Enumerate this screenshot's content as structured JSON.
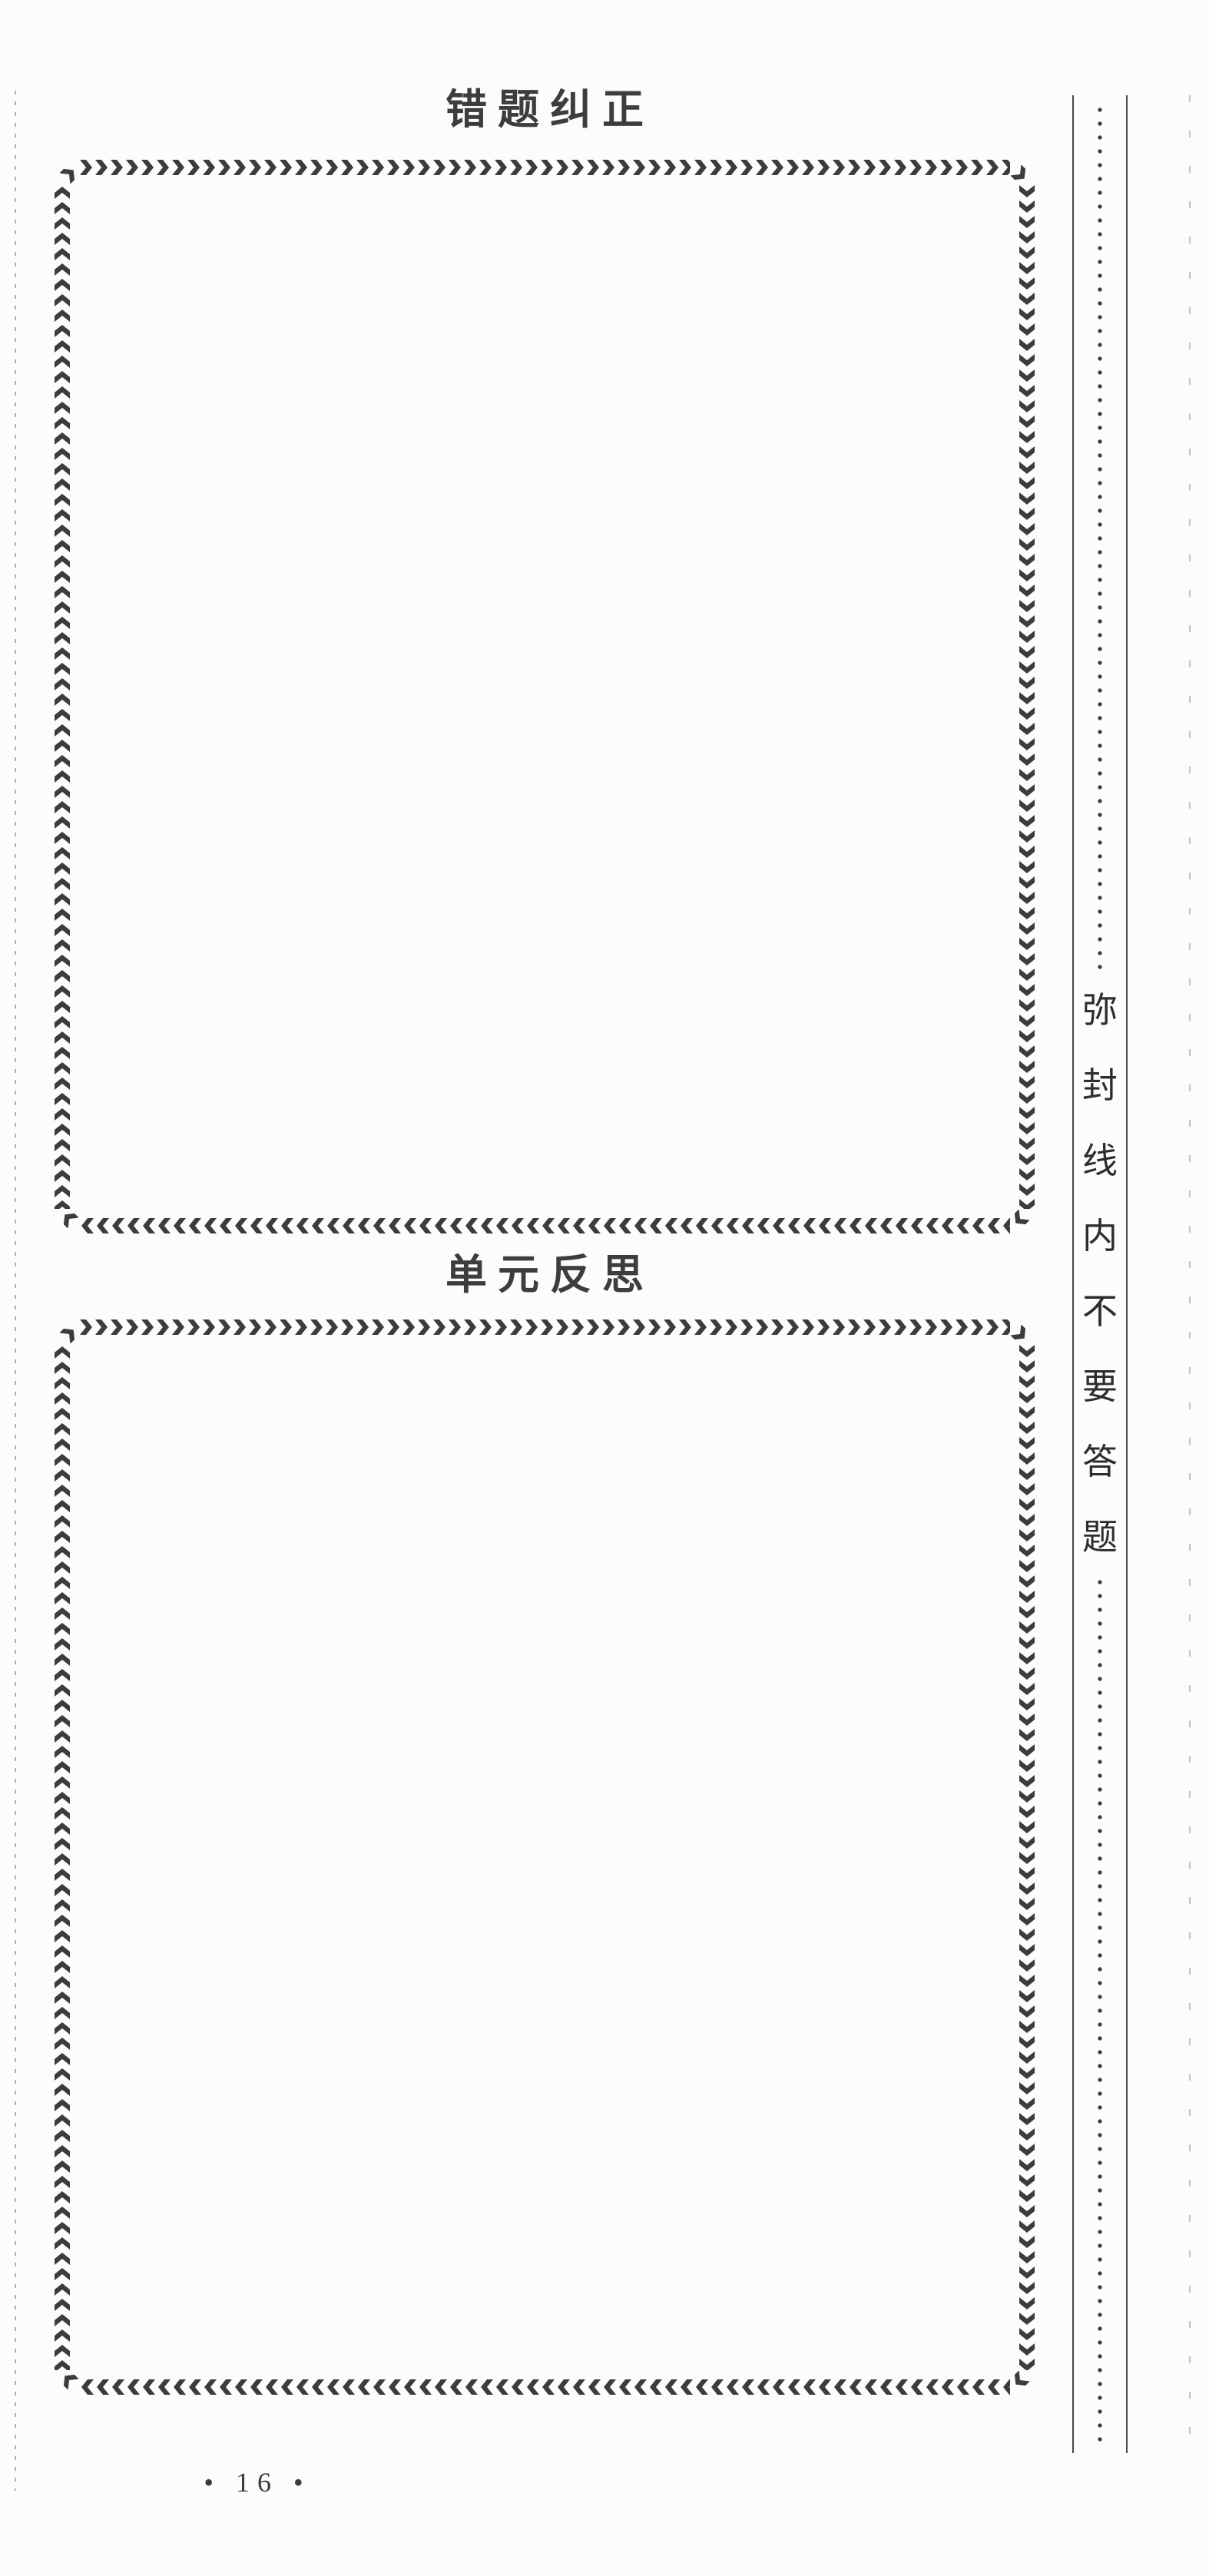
{
  "page": {
    "titles": [
      {
        "label": "错题纠正"
      },
      {
        "label": "单元反思"
      }
    ],
    "page_number": "• 16 •"
  },
  "seal_sidebar": {
    "text": "弥封线内不要答题",
    "chars": [
      "弥",
      "封",
      "线",
      "内",
      "不",
      "要",
      "答",
      "题"
    ]
  },
  "icons": {
    "chevron_right": "❯",
    "chevron_left": "❮",
    "chevron_up": "⌃",
    "chevron_down": "⌄",
    "bullet": "•"
  },
  "colors": {
    "ink": "#3c3c3c",
    "seal_line": "#4a4a4a",
    "faint_fold_line": "#c2c2c2",
    "paper": "#fcfcfb"
  }
}
